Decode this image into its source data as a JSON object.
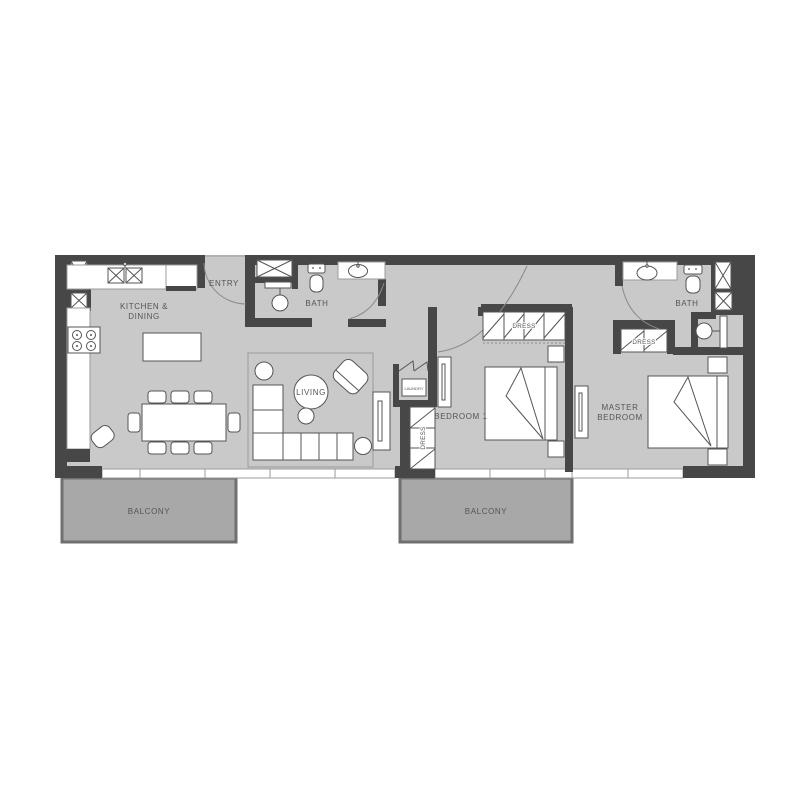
{
  "theme": {
    "wall_color": "#474747",
    "floor_color": "#c9c9c9",
    "balcony_color": "#a8a8a8",
    "balcony_border": "#6f6f6f",
    "line_color": "#555555",
    "light_line": "#9b9b9b",
    "label_color": "#555555",
    "background": "#ffffff"
  },
  "labels": {
    "kitchen_line1": "KITCHEN &",
    "kitchen_line2": "DINING",
    "entry": "ENTRY",
    "bath1": "BATH",
    "living": "LIVING",
    "laundry": "LAUNDRY",
    "dress_hall": "DRESS",
    "bedroom1": "BEDROOM 1",
    "dress_bedroom1": "DRESS",
    "master_line1": "MASTER",
    "master_line2": "BEDROOM",
    "dress_master": "DRESS",
    "bath2": "BATH",
    "balcony_left": "BALCONY",
    "balcony_right": "BALCONY"
  },
  "fixtures": [
    "duct-shaft",
    "kitchen-double-sink",
    "stove",
    "kitchen-island",
    "dining-table",
    "dining-chair",
    "armchair",
    "rug",
    "sofa",
    "coffee-table",
    "side-table",
    "tv-console",
    "shower-enclosure",
    "shower-head",
    "toilet",
    "washbasin",
    "laundry-closet",
    "wardrobe",
    "mirror",
    "bed",
    "nightstand",
    "door-swing",
    "window-band",
    "balcony"
  ]
}
